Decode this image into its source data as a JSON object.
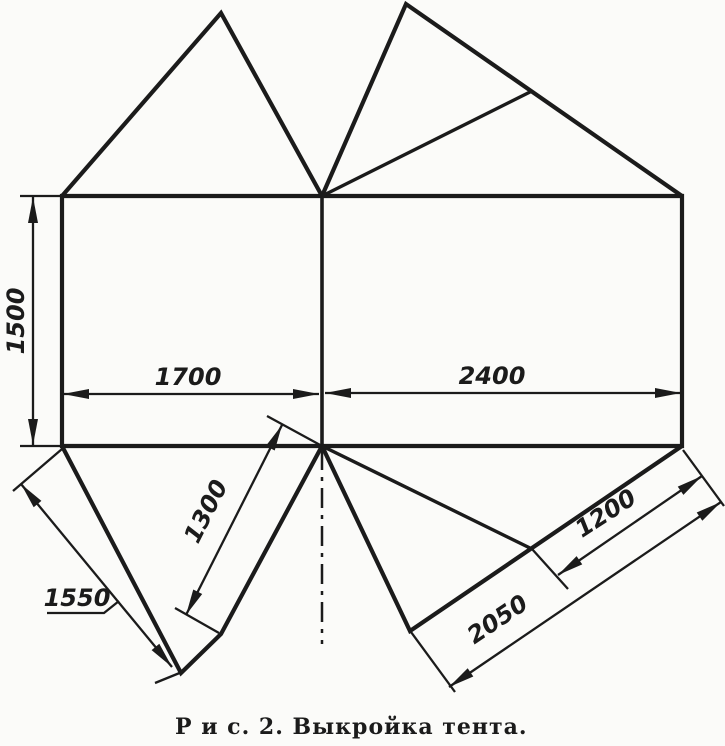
{
  "figure": {
    "type": "technical-pattern-drawing",
    "caption": "Р и с. 2. Выкройка тента."
  },
  "canvas": {
    "width": 725,
    "height": 746,
    "background": "#fbfbf9",
    "ink": "#1b1b1b"
  },
  "pattern": {
    "outlines": [
      {
        "name": "main-rectangle",
        "closed": true,
        "points": [
          [
            62,
            196
          ],
          [
            682,
            196
          ],
          [
            682,
            446
          ],
          [
            62,
            446
          ]
        ]
      },
      {
        "name": "center-divider",
        "closed": false,
        "class": "divider",
        "points": [
          [
            322,
            196
          ],
          [
            322,
            446
          ]
        ]
      },
      {
        "name": "top-left-flap",
        "closed": false,
        "points": [
          [
            62,
            196
          ],
          [
            221,
            13
          ],
          [
            322,
            196
          ]
        ]
      },
      {
        "name": "top-right-flap",
        "closed": false,
        "points": [
          [
            322,
            196
          ],
          [
            406,
            4
          ],
          [
            682,
            196
          ]
        ]
      },
      {
        "name": "bottom-left-flap",
        "closed": false,
        "points": [
          [
            62,
            446
          ],
          [
            181,
            673
          ],
          [
            221,
            634
          ],
          [
            322,
            446
          ]
        ]
      },
      {
        "name": "bottom-right-flap",
        "closed": false,
        "points": [
          [
            322,
            446
          ],
          [
            410,
            631
          ],
          [
            682,
            446
          ]
        ]
      }
    ],
    "creases": [
      {
        "name": "top-right-crease",
        "points": [
          [
            322,
            196
          ],
          [
            532,
            91
          ]
        ]
      },
      {
        "name": "bottom-right-crease",
        "points": [
          [
            322,
            446
          ],
          [
            532,
            549
          ]
        ]
      }
    ],
    "centerline": {
      "name": "vertical-centerline",
      "points": [
        [
          322,
          450
        ],
        [
          322,
          644
        ]
      ]
    },
    "extension_lines": [
      {
        "name": "ext-top-left",
        "points": [
          [
            20,
            196
          ],
          [
            62,
            196
          ]
        ]
      },
      {
        "name": "ext-bottom-left",
        "points": [
          [
            20,
            446
          ],
          [
            62,
            446
          ]
        ]
      },
      {
        "name": "ext-1550-top",
        "points": [
          [
            62,
            449
          ],
          [
            13,
            491
          ]
        ]
      },
      {
        "name": "ext-1550-bottom",
        "points": [
          [
            182,
            672
          ],
          [
            155,
            683
          ]
        ]
      },
      {
        "name": "ext-1300-top",
        "points": [
          [
            322,
            446
          ],
          [
            267,
            416
          ]
        ]
      },
      {
        "name": "ext-1300-bottom",
        "points": [
          [
            219,
            633
          ],
          [
            175,
            608
          ]
        ]
      },
      {
        "name": "ext-1200-left",
        "points": [
          [
            532,
            549
          ],
          [
            568,
            589
          ]
        ]
      },
      {
        "name": "ext-right-corner",
        "points": [
          [
            683,
            450
          ],
          [
            724,
            506
          ]
        ]
      },
      {
        "name": "ext-2050-left",
        "points": [
          [
            411,
            632
          ],
          [
            455,
            692
          ]
        ]
      }
    ],
    "dimensions": [
      {
        "label": "1500",
        "line": [
          [
            33,
            197
          ],
          [
            33,
            445
          ]
        ],
        "label_pos": [
          24,
          321
        ],
        "label_rotate": -90
      },
      {
        "label": "1700",
        "line": [
          [
            63,
            394
          ],
          [
            319,
            394
          ]
        ],
        "label_pos": [
          188,
          385
        ],
        "label_rotate": 0
      },
      {
        "label": "2400",
        "line": [
          [
            325,
            393
          ],
          [
            681,
            393
          ]
        ],
        "label_pos": [
          492,
          384
        ],
        "label_rotate": 0
      },
      {
        "label": "1300",
        "line": [
          [
            282,
            425
          ],
          [
            186,
            615
          ]
        ],
        "label_pos": [
          213,
          515
        ],
        "label_rotate": -63
      },
      {
        "label": "1550",
        "line": [
          [
            21,
            484
          ],
          [
            172,
            667
          ]
        ],
        "label_pos": [
          77,
          606
        ],
        "label_rotate": 0,
        "leader": [
          [
            47,
            613
          ],
          [
            104,
            613
          ],
          [
            119,
            601
          ]
        ]
      },
      {
        "label": "1200",
        "line": [
          [
            558,
            575
          ],
          [
            702,
            476
          ]
        ],
        "label_pos": [
          610,
          520
        ],
        "label_rotate": -33
      },
      {
        "label": "2050",
        "line": [
          [
            449,
            687
          ],
          [
            721,
            502
          ]
        ],
        "label_pos": [
          502,
          626
        ],
        "label_rotate": -34
      }
    ]
  }
}
